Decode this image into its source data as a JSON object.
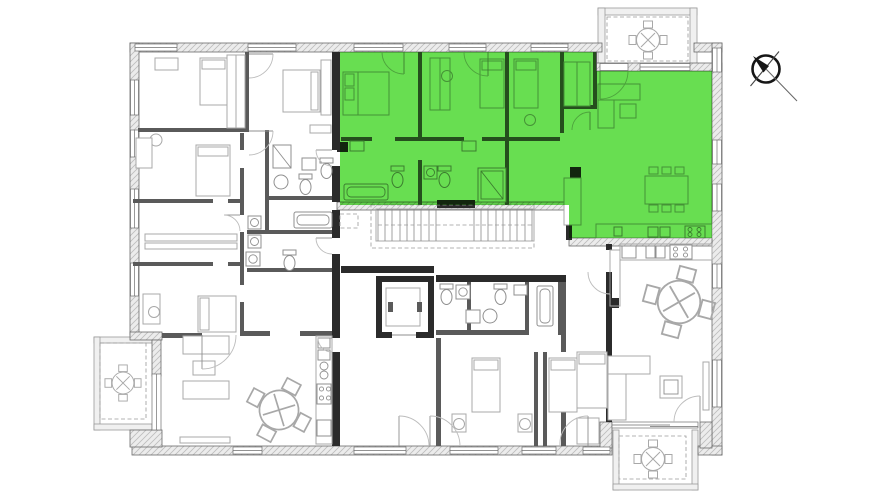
{
  "floor_plan": {
    "canvas": {
      "width": 889,
      "height": 500,
      "background": "#ffffff"
    },
    "highlight": {
      "color": "#58da3e",
      "opacity": 0.9,
      "position": "upper-right-unit"
    },
    "palette": {
      "exterior_wall_fill": "#ececec",
      "exterior_wall_hatch": "#bdbdbd",
      "exterior_wall_edge": "#6a6a6a",
      "partition_wall": "#2b2b2b",
      "interior_wall": "#5a5a5a",
      "furniture_line": "#a8a8a8",
      "fixture_line": "#8f8f8f",
      "door_arc": "#bcbcbc",
      "stair_line": "#8a8a8a",
      "north_arrow": "#161616"
    },
    "elements": {
      "balconies": 3,
      "staircase_flights": 2,
      "elevator": true,
      "north_arrow_icon": "north-arrow"
    }
  }
}
